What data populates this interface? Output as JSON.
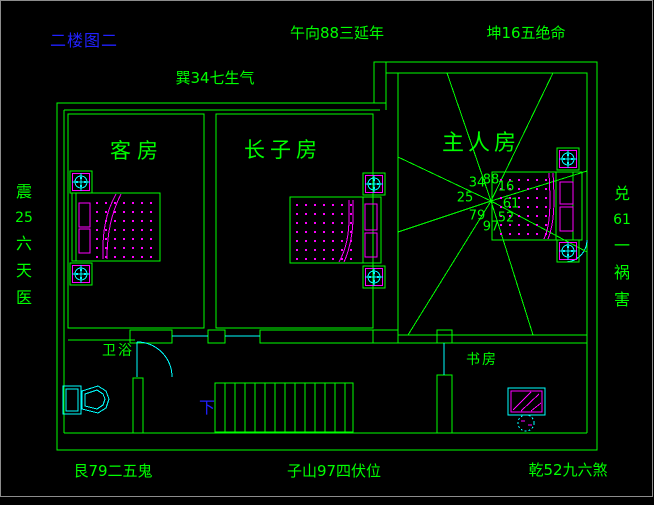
{
  "title": "二楼图二",
  "fengshui_labels": {
    "top_center": "午向88三延年",
    "top_right": "坤16五绝命",
    "upper_left": "巽34七生气",
    "left": "震25六天医",
    "right": "兑61一祸害",
    "bottom_left": "艮79二五鬼",
    "bottom_center": "子山97四伏位",
    "bottom_right": "乾52九六煞"
  },
  "rooms": {
    "guest": "客房",
    "eldest_son": "长子房",
    "master": "主人房",
    "bathroom": "卫浴",
    "study": "书房"
  },
  "stairs": {
    "down_label": "下"
  },
  "palace_numbers": [
    "34",
    "88",
    "16",
    "25",
    "61",
    "79",
    "97",
    "52"
  ],
  "colors": {
    "line_green": "#00ff00",
    "fixture_cyan": "#00ffff",
    "detail_magenta": "#ff00ff",
    "text_blue": "#2121ff",
    "frame_grey": "#8c8c8c"
  }
}
